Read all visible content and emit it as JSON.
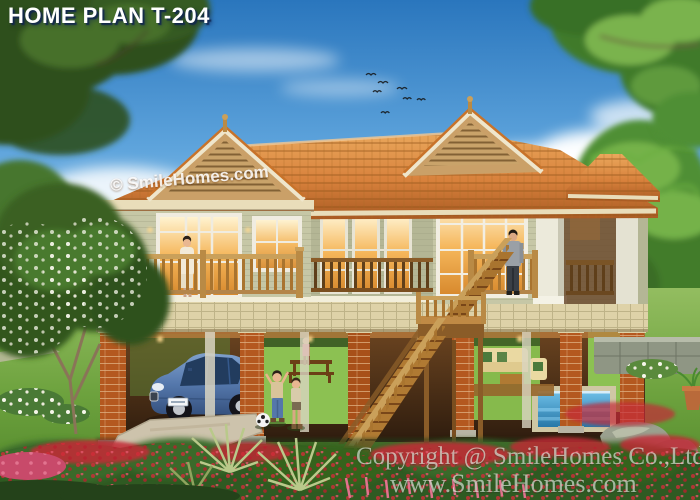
{
  "title": "HOME PLAN T-204",
  "roof_watermark": "© SmileHomes.com",
  "footer": {
    "copyright": "Copyright @ SmileHomes Co.,Ltd",
    "website": "www.SmileHomes.com"
  },
  "palette": {
    "sky_top": "#2a76bd",
    "sky_horizon": "#cfe8f6",
    "roof_tile": "#d8813c",
    "roof_tile_dark": "#a85a22",
    "gable_louver": "#c9a36a",
    "wall_siding": "#c6c7a6",
    "trim_white": "#f2eeda",
    "wood_rail": "#b07a33",
    "brick_pier": "#b4581f",
    "tile_band": "#ded2a8",
    "lawn_green": "#7cab4a",
    "bush_green": "#2f5a22",
    "flower_red": "#d02c38",
    "flower_pink": "#e2738f",
    "car_blue": "#45659c",
    "pool_blue": "#3f9fd0",
    "interior_glow": "#ffcf7e"
  },
  "scene": {
    "birds_count": 7,
    "people": [
      "woman-on-left-balcony",
      "man-on-right-balcony",
      "boy-playing",
      "girl-playing",
      "child-at-table"
    ],
    "objects": [
      "two-story-stilt-house",
      "blue-sedan-car",
      "wooden-staircase",
      "soccer-ball",
      "garden-pool",
      "outdoor-sofa-set",
      "frangipani-tree",
      "palm-trees",
      "rock-garden"
    ]
  }
}
